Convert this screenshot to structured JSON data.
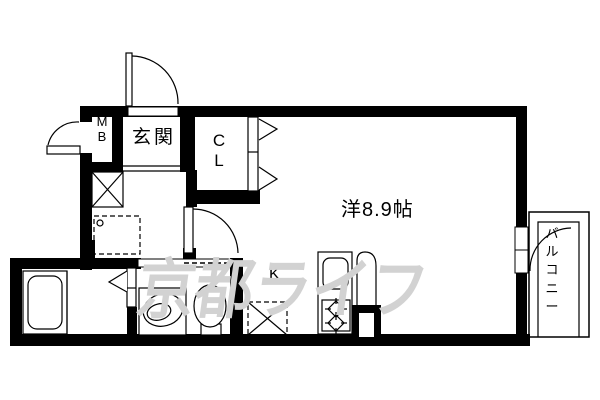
{
  "floor_plan": {
    "labels": {
      "genkan": "玄関",
      "meter_box": "MB",
      "closet": "CL",
      "western_room": "洋8.9帖",
      "kitchen": "K",
      "balcony": "バルコニー"
    },
    "watermark": {
      "text": "京都ライフ",
      "color": "#d2d2d2"
    },
    "colors": {
      "wall": "#000000",
      "lines": "#000000",
      "floor": "#ffffff",
      "watermark": "#d2d2d2"
    },
    "fixtures": [
      "entrance-door-swing",
      "meter-box-door-swing",
      "duct-shaft-x",
      "washing-machine-space",
      "bathtub",
      "bathroom-folding-door",
      "vanity-basin",
      "toilet",
      "washroom-sliding-door",
      "hall-door-swing",
      "closet-folding-door",
      "refrigerator-space-x",
      "kitchen-sink",
      "gas-stove-2-burner",
      "kitchen-door",
      "balcony-window",
      "balcony-door-swing"
    ]
  }
}
